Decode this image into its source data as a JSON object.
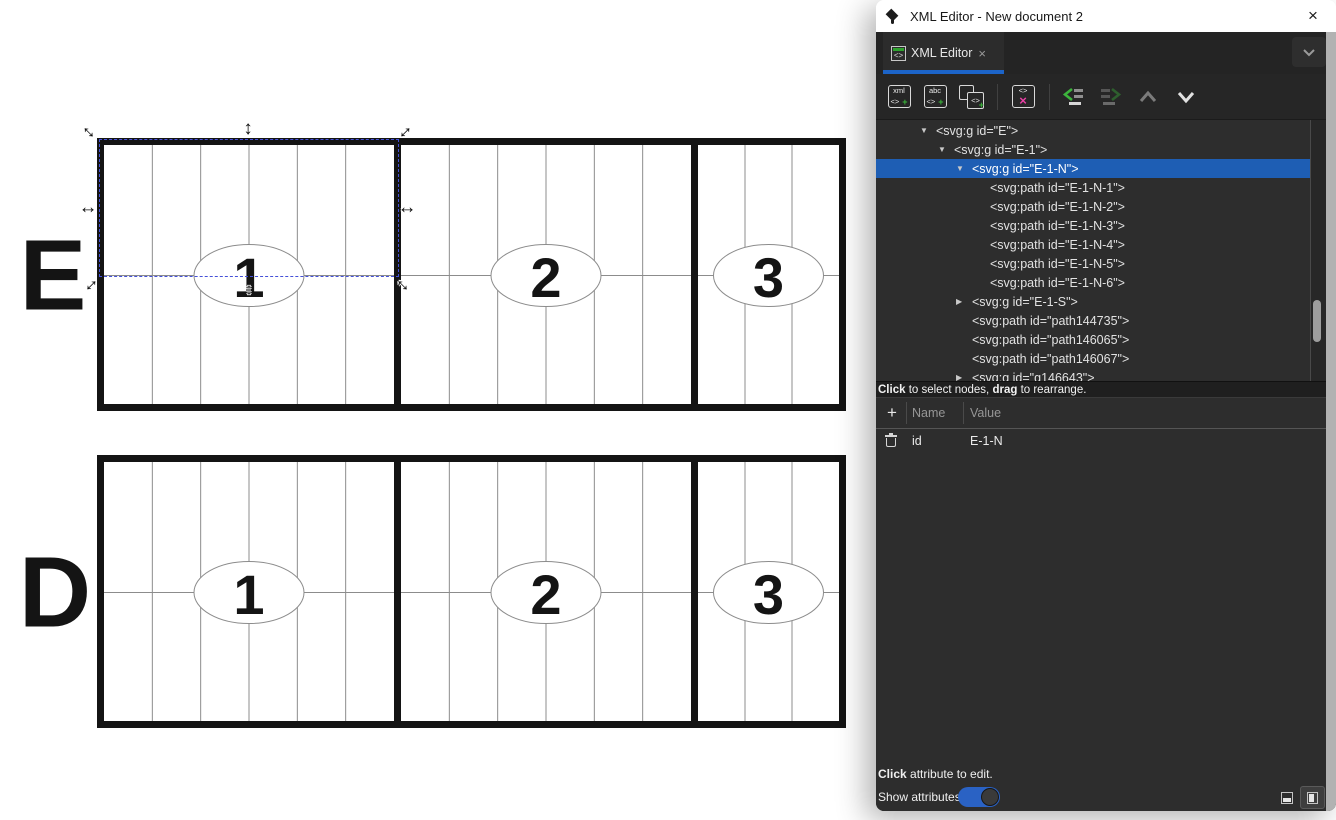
{
  "window": {
    "title": "XML Editor - New document 2",
    "close_glyph": "×"
  },
  "tab": {
    "label": "XML Editor",
    "close_glyph": "×"
  },
  "toolbar": {
    "new_element": {
      "top": "xml",
      "bottom": "<>",
      "plus": "+"
    },
    "new_text": {
      "top": "abc",
      "bottom": "<>",
      "plus": "+"
    },
    "duplicate": {
      "bottom": "<>",
      "plus": "+"
    },
    "delete": {
      "top": "<>",
      "x": "×"
    }
  },
  "xml_editor": {
    "tree": {
      "nodes": [
        {
          "indent": 0,
          "expander": "open",
          "label": "<svg:g id=\"E\">",
          "selected": false
        },
        {
          "indent": 1,
          "expander": "open",
          "label": "<svg:g id=\"E-1\">",
          "selected": false
        },
        {
          "indent": 2,
          "expander": "open",
          "label": "<svg:g id=\"E-1-N\">",
          "selected": true
        },
        {
          "indent": 3,
          "expander": "none",
          "label": "<svg:path id=\"E-1-N-1\">",
          "selected": false
        },
        {
          "indent": 3,
          "expander": "none",
          "label": "<svg:path id=\"E-1-N-2\">",
          "selected": false
        },
        {
          "indent": 3,
          "expander": "none",
          "label": "<svg:path id=\"E-1-N-3\">",
          "selected": false
        },
        {
          "indent": 3,
          "expander": "none",
          "label": "<svg:path id=\"E-1-N-4\">",
          "selected": false
        },
        {
          "indent": 3,
          "expander": "none",
          "label": "<svg:path id=\"E-1-N-5\">",
          "selected": false
        },
        {
          "indent": 3,
          "expander": "none",
          "label": "<svg:path id=\"E-1-N-6\">",
          "selected": false
        },
        {
          "indent": 2,
          "expander": "closed",
          "label": "<svg:g id=\"E-1-S\">",
          "selected": false
        },
        {
          "indent": 2,
          "expander": "none",
          "label": "<svg:path id=\"path144735\">",
          "selected": false
        },
        {
          "indent": 2,
          "expander": "none",
          "label": "<svg:path id=\"path146065\">",
          "selected": false
        },
        {
          "indent": 2,
          "expander": "none",
          "label": "<svg:path id=\"path146067\">",
          "selected": false
        },
        {
          "indent": 2,
          "expander": "closed",
          "label": "<svg:g id=\"g146643\">",
          "selected": false
        }
      ],
      "expander_open_glyph": "▼",
      "expander_closed_glyph": "▶"
    }
  },
  "status": {
    "part1": "Click",
    "part2": " to select nodes, ",
    "part3": "drag",
    "part4": " to rearrange."
  },
  "attributes": {
    "add_glyph": "+",
    "name_header": "Name",
    "value_header": "Value",
    "rows": [
      {
        "name": "id",
        "value": "E-1-N"
      }
    ]
  },
  "bottom": {
    "hint1_part1": "Click",
    "hint1_part2": " attribute to edit.",
    "show_label": "Show attributes",
    "show_attributes_on": true
  },
  "colors": {
    "accent_blue": "#1c64c8",
    "selected_row": "#1e5eb4",
    "toggle_blue": "#2a62c4",
    "green_accent": "#39b539",
    "magenta_accent": "#ec3fa6"
  },
  "canvas": {
    "rows": [
      {
        "label": "E",
        "sections": [
          {
            "num": "1",
            "cols": 6
          },
          {
            "num": "2",
            "cols": 6
          },
          {
            "num": "3",
            "cols": 3
          }
        ]
      },
      {
        "label": "D",
        "sections": [
          {
            "num": "1",
            "cols": 6
          },
          {
            "num": "2",
            "cols": 6
          },
          {
            "num": "3",
            "cols": 3
          }
        ]
      }
    ],
    "selection": {
      "target_id": "E-1-N",
      "h_glyph": "↔",
      "v_glyph": "↕"
    }
  }
}
